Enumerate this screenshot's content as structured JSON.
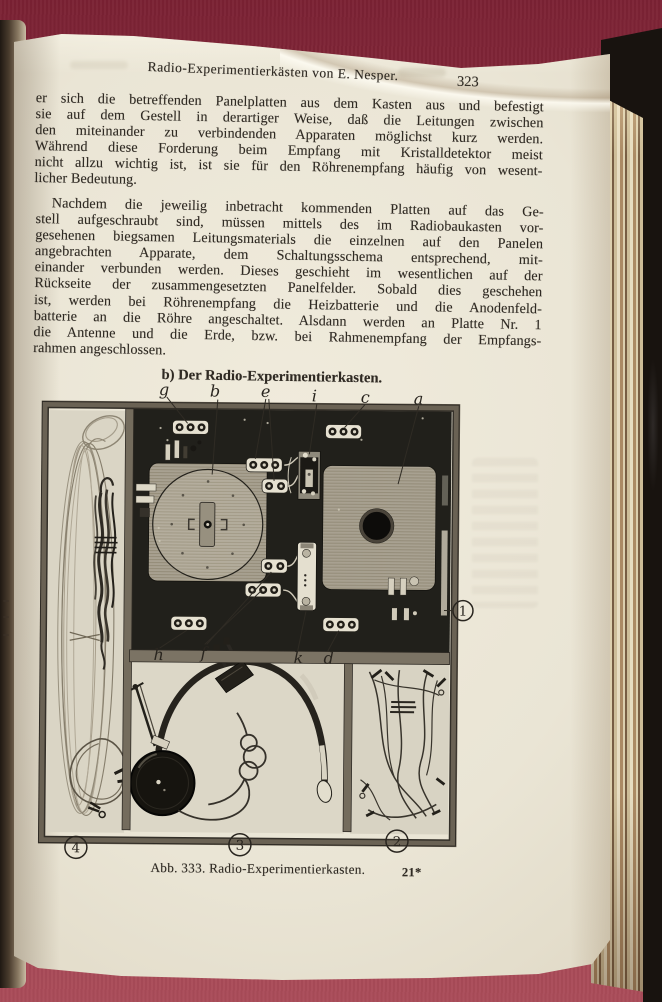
{
  "book_page": {
    "running_header": {
      "title": "Radio-Experimentierkästen von E. Nesper.",
      "page_number": "323"
    },
    "paragraph_1": [
      "er sich die betreffenden Panelplatten aus dem Kasten aus und befestigt",
      "sie auf dem Gestell in derartiger Weise, daß die Leitungen zwischen",
      "den miteinander zu verbindenden Apparaten möglichst kurz werden.",
      "Während diese Forderung beim Empfang mit Kristalldetektor meist",
      "nicht allzu wichtig ist, ist sie für den Röhrenempfang häufig von wesent-",
      "licher Bedeutung."
    ],
    "paragraph_2": [
      "Nachdem die jeweilig inbetracht kommenden Platten auf das Ge-",
      "stell aufgeschraubt sind, müssen mittels des im Radiobaukasten vor-",
      "gesehenen biegsamen Leitungsmaterials die einzelnen auf den Panelen",
      "angebrachten Apparate, dem Schaltungsschema entsprechend, mit-",
      "einander verbunden werden. Dieses geschieht im wesentlichen auf der",
      "Rückseite der zusammengesetzten Panelfelder. Sobald dies geschehen",
      "ist, werden bei Röhrenempfang die Heizbatterie und die Anodenfeld-",
      "batterie an die Röhre angeschaltet. Alsdann werden an Platte Nr. 1",
      "die Antenne und die Erde, bzw. bei Rahmenempfang der Empfangs-",
      "rahmen angeschlossen."
    ],
    "section_heading": "b) Der Radio-Experimentierkasten.",
    "figure": {
      "caption": "Abb. 333. Radio-Experimentierkasten.",
      "signature_mark": "21*",
      "part_labels_top": [
        "g",
        "b",
        "e",
        "i",
        "c",
        "a"
      ],
      "part_labels_bottom": [
        "h",
        "f",
        "k",
        "d"
      ],
      "compartment_numbers": [
        "1",
        "2",
        "3",
        "4"
      ]
    }
  },
  "colors": {
    "cloth_background": "#8e2f40",
    "paper": "#eae5d5",
    "book_cover": "#18130f",
    "fore_edge_gold": "#c7ab7f",
    "ink": "#2b2722"
  }
}
